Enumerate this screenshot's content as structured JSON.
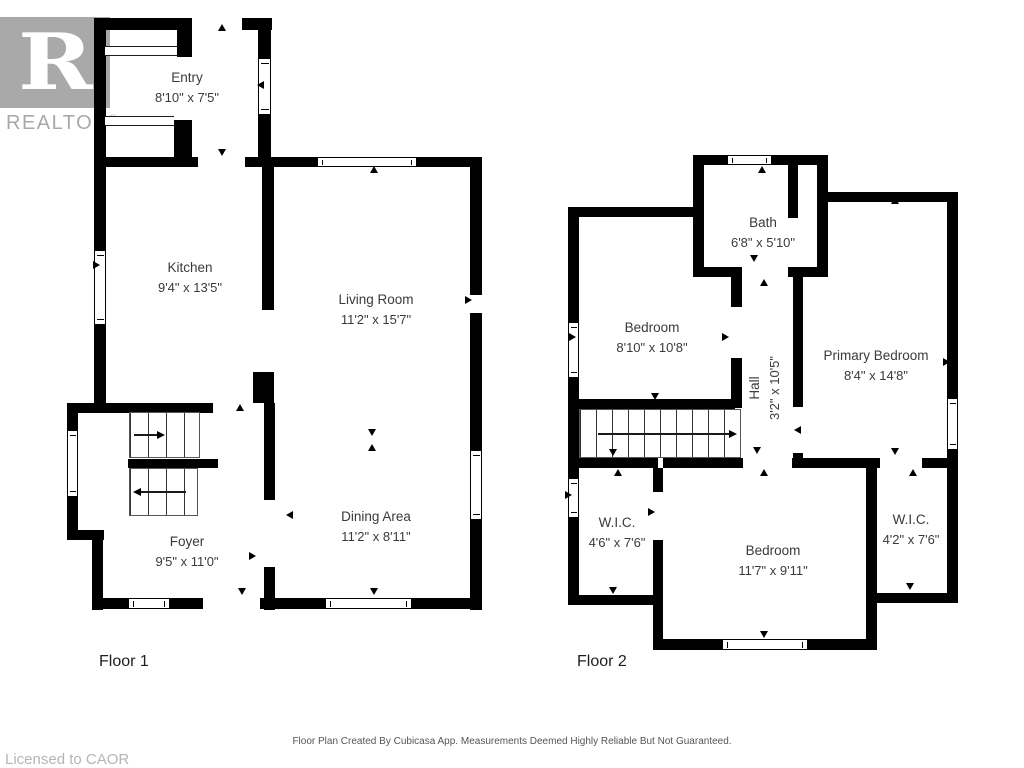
{
  "logo": {
    "letter": "R",
    "brand": "REALTOR",
    "registered": "®"
  },
  "floor1": {
    "label": "Floor 1",
    "rooms": {
      "entry": {
        "name": "Entry",
        "dims": "8'10\" x 7'5\""
      },
      "kitchen": {
        "name": "Kitchen",
        "dims": "9'4\" x 13'5\""
      },
      "living": {
        "name": "Living Room",
        "dims": "11'2\" x 15'7\""
      },
      "dining": {
        "name": "Dining Area",
        "dims": "11'2\" x 8'11\""
      },
      "foyer": {
        "name": "Foyer",
        "dims": "9'5\" x 11'0\""
      }
    }
  },
  "floor2": {
    "label": "Floor 2",
    "rooms": {
      "bath": {
        "name": "Bath",
        "dims": "6'8\" x 5'10\""
      },
      "bedroom1": {
        "name": "Bedroom",
        "dims": "8'10\" x 10'8\""
      },
      "primary": {
        "name": "Primary Bedroom",
        "dims": "8'4\" x 14'8\""
      },
      "hall": {
        "name": "Hall",
        "dims": "3'2\" x 10'5\""
      },
      "wic_left": {
        "name": "W.I.C.",
        "dims": "4'6\" x 7'6\""
      },
      "bedroom2": {
        "name": "Bedroom",
        "dims": "11'7\" x 9'11\""
      },
      "wic_right": {
        "name": "W.I.C.",
        "dims": "4'2\" x 7'6\""
      }
    }
  },
  "footer": {
    "disclaimer": "Floor Plan Created By Cubicasa App. Measurements Deemed Highly Reliable But Not Guaranteed.",
    "license": "Licensed to CAOR"
  },
  "colors": {
    "wall": "#000000",
    "logo_gray": "#a9a9a9",
    "text": "#3a3a3a",
    "muted": "#b5b5b5"
  }
}
